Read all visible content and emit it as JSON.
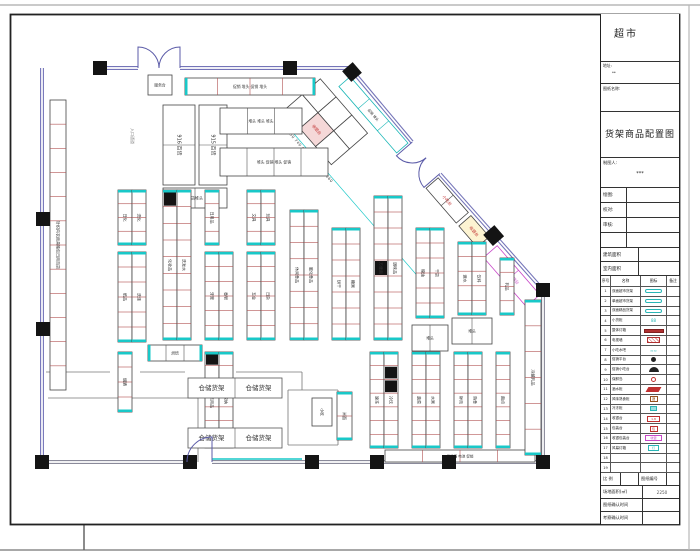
{
  "title_block": {
    "project": "超市",
    "address_label": "地址:",
    "address_value": "**",
    "drawing_name_label": "图纸名称:",
    "drawing_title": "货架商品配置图",
    "drafter_label": "制图人:",
    "drafter_value": "***",
    "sign_rows": [
      {
        "label": "绘图:"
      },
      {
        "label": "校对:"
      },
      {
        "label": "审核:"
      },
      {
        "label": ""
      }
    ],
    "area_rows": [
      {
        "label": "建筑面积"
      },
      {
        "label": "室内面积"
      }
    ],
    "legend": {
      "headers": [
        "序号",
        "名称",
        "图标",
        "备注"
      ],
      "rows": [
        {
          "no": "1",
          "name": "双面超市货架",
          "sym": "pillc",
          "symText": ""
        },
        {
          "no": "2",
          "name": "单面超市货架",
          "sym": "pillc",
          "symText": ""
        },
        {
          "no": "3",
          "name": "双面精品货架",
          "sym": "pillc",
          "symText": ""
        },
        {
          "no": "4",
          "name": "小货柜",
          "sym": "tealt",
          "symText": "88"
        },
        {
          "no": "5",
          "name": "整体灯箱",
          "sym": "barr",
          "symText": ""
        },
        {
          "no": "6",
          "name": "电视墙",
          "sym": "hatchr",
          "symText": ""
        },
        {
          "no": "7",
          "name": "小吃水吧",
          "sym": "tealt",
          "symText": "≈≈"
        },
        {
          "no": "8",
          "name": "促销平台",
          "sym": "circb",
          "symText": ""
        },
        {
          "no": "9",
          "name": "促销小吃台",
          "sym": "domeb",
          "symText": ""
        },
        {
          "no": "10",
          "name": "保鲜岛",
          "sym": "ringr",
          "symText": ""
        },
        {
          "no": "11",
          "name": "酒水柜",
          "sym": "parar",
          "symText": ""
        },
        {
          "no": "12",
          "name": "风味熟食柜",
          "sym": "boxbr",
          "symText": "酒"
        },
        {
          "no": "13",
          "name": "冷冻柜",
          "sym": "boxcf",
          "symText": ""
        },
        {
          "no": "14",
          "name": "收银台",
          "sym": "boxr",
          "symText": "1.8"
        },
        {
          "no": "15",
          "name": "包装台",
          "sym": "boxr2",
          "symText": "包"
        },
        {
          "no": "16",
          "name": "收银包装台",
          "sym": "boxm",
          "symText": "收银"
        },
        {
          "no": "17",
          "name": "风幕灯箱",
          "sym": "boxc",
          "symText": "灯"
        },
        {
          "no": "18",
          "name": "",
          "sym": "none",
          "symText": ""
        },
        {
          "no": "19",
          "name": "",
          "sym": "none",
          "symText": ""
        }
      ]
    },
    "footer": {
      "scale_label": "比 例",
      "scale_value": "",
      "no_label": "图纸编号",
      "no_value": "",
      "site_label": "场地面积(㎡)",
      "site_value": "2250",
      "confirm_drawing_label": "图纸确认时间",
      "confirm_drawing_value": "",
      "confirm_survey_label": "考察确认时间",
      "confirm_survey_value": ""
    }
  },
  "plan": {
    "walls": [
      {
        "x1": 100,
        "y1": 68,
        "x2": 138,
        "y2": 68
      },
      {
        "x1": 180,
        "y1": 68,
        "x2": 350,
        "y2": 68
      },
      {
        "x1": 350,
        "y1": 68,
        "x2": 412,
        "y2": 142
      },
      {
        "x1": 440,
        "y1": 174,
        "x2": 543,
        "y2": 290
      },
      {
        "x1": 543,
        "y1": 290,
        "x2": 543,
        "y2": 462,
        "c": "#8a8a9a"
      },
      {
        "x1": 543,
        "y1": 462,
        "x2": 212,
        "y2": 462,
        "c": "#8a8a9a"
      },
      {
        "x1": 186,
        "y1": 462,
        "x2": 42,
        "y2": 462,
        "c": "#8a8a9a"
      },
      {
        "x1": 42,
        "y1": 68,
        "x2": 42,
        "y2": 462
      }
    ],
    "lines": [
      {
        "x1": 48,
        "y1": 398,
        "x2": 198,
        "y2": 398
      },
      {
        "x1": 198,
        "y1": 398,
        "x2": 198,
        "y2": 462
      },
      {
        "x1": 46,
        "y1": 372,
        "x2": 110,
        "y2": 372
      },
      {
        "x1": 140,
        "y1": 372,
        "x2": 185,
        "y2": 372
      },
      {
        "x1": 236,
        "y1": 372,
        "x2": 302,
        "y2": 372
      },
      {
        "x1": 302,
        "y1": 372,
        "x2": 302,
        "y2": 390
      },
      {
        "x1": 288,
        "y1": 390,
        "x2": 338,
        "y2": 390
      },
      {
        "x1": 288,
        "y1": 390,
        "x2": 288,
        "y2": 445
      },
      {
        "x1": 338,
        "y1": 390,
        "x2": 338,
        "y2": 445
      },
      {
        "x1": 288,
        "y1": 445,
        "x2": 338,
        "y2": 445
      },
      {
        "x1": 212,
        "y1": 459,
        "x2": 302,
        "y2": 459,
        "c": "#19c8c8",
        "w": 1.4
      }
    ],
    "columns": [
      [
        93,
        61
      ],
      [
        283,
        61
      ],
      [
        36,
        212
      ],
      [
        36,
        322
      ],
      [
        35,
        455
      ],
      [
        183,
        455
      ],
      [
        305,
        455
      ],
      [
        370,
        455
      ],
      [
        442,
        455
      ],
      [
        536,
        455
      ],
      [
        536,
        283
      ]
    ],
    "diamond_columns": [
      [
        352,
        72
      ]
    ],
    "doors": [
      {
        "d": "M138 68 L138 47 A21 21 0 0 1 159 68"
      },
      {
        "d": "M180 68 L180 47 A21 21 0 0 0 159 68"
      },
      {
        "d": "M446 68 L446 89 A21 21 0 0 0 467 68",
        "grp": 1
      },
      {
        "d": "M488 68 L488 89 A21 21 0 0 1 467 68",
        "grp": 1
      },
      {
        "d": "M212 462 L212 437 A25 25 0 0 0 187 462"
      }
    ],
    "fixtures": [
      {
        "x": 148,
        "y": 75,
        "w": 24,
        "h": 20,
        "c": 1,
        "label": "服务台",
        "fs": 3.8
      },
      {
        "x": 185,
        "y": 78,
        "w": 130,
        "h": 17,
        "c": 4,
        "cp": 1,
        "dc": "#b05050",
        "label": "促销 堆头 促销 堆头",
        "fs": 3.8
      },
      {
        "x": 163,
        "y": 105,
        "w": 32,
        "h": 80,
        "c": 2,
        "label": "916 百货",
        "fs": 5
      },
      {
        "x": 199,
        "y": 105,
        "w": 28,
        "h": 80,
        "c": 2,
        "label": "915 百货",
        "fs": 5
      },
      {
        "x": 163,
        "y": 188,
        "w": 64,
        "h": 20,
        "c": 2,
        "label": "百货堆头",
        "fs": 4
      },
      {
        "x": 220,
        "y": 108,
        "w": 82,
        "h": 26,
        "c": 3,
        "label": "堆头 堆头 堆头",
        "fs": 3.8
      },
      {
        "x": 220,
        "y": 148,
        "w": 108,
        "h": 28,
        "c": 4,
        "label": "堆头 促销 堆头 促销",
        "fs": 3.8
      },
      {
        "x": 50,
        "y": 100,
        "w": 16,
        "h": 290,
        "c": 12,
        "dc": "#b05050",
        "label": "针织内衣雨具箱包日用百货",
        "fs": 4
      },
      {
        "x": 118,
        "y": 190,
        "w": 14,
        "h": 55,
        "c": 4,
        "cp": 1,
        "dc": "#b05050",
        "label": "日化",
        "fs": 4
      },
      {
        "x": 132,
        "y": 190,
        "w": 14,
        "h": 55,
        "c": 4,
        "cp": 1,
        "dc": "#b05050",
        "label": "洗化",
        "fs": 4
      },
      {
        "x": 118,
        "y": 252,
        "w": 14,
        "h": 90,
        "c": 6,
        "cp": 1,
        "dc": "#b05050",
        "label": "纸品",
        "fs": 4
      },
      {
        "x": 132,
        "y": 252,
        "w": 14,
        "h": 90,
        "c": 6,
        "cp": 1,
        "dc": "#b05050",
        "label": "洗涤",
        "fs": 4
      },
      {
        "x": 163,
        "y": 190,
        "w": 14,
        "h": 150,
        "c": 9,
        "cp": 1,
        "bk": [
          0
        ],
        "dc": "#b05050",
        "label": "化妆品",
        "fs": 4
      },
      {
        "x": 177,
        "y": 190,
        "w": 14,
        "h": 150,
        "c": 9,
        "cp": 1,
        "dc": "#b05050",
        "label": "洗发水",
        "fs": 4
      },
      {
        "x": 205,
        "y": 190,
        "w": 14,
        "h": 55,
        "c": 4,
        "cp": 1,
        "dc": "#b05050",
        "label": "日用品",
        "fs": 4
      },
      {
        "x": 205,
        "y": 252,
        "w": 14,
        "h": 88,
        "c": 6,
        "cp": 1,
        "dc": "#b05050",
        "label": "牙膏",
        "fs": 4
      },
      {
        "x": 219,
        "y": 252,
        "w": 14,
        "h": 88,
        "c": 6,
        "cp": 1,
        "dc": "#b05050",
        "label": "香皂",
        "fs": 4
      },
      {
        "x": 247,
        "y": 190,
        "w": 14,
        "h": 55,
        "c": 4,
        "cp": 1,
        "dc": "#b05050",
        "label": "文具",
        "fs": 4
      },
      {
        "x": 261,
        "y": 190,
        "w": 14,
        "h": 55,
        "c": 4,
        "cp": 1,
        "dc": "#b05050",
        "label": "玩具",
        "fs": 4
      },
      {
        "x": 247,
        "y": 252,
        "w": 14,
        "h": 88,
        "c": 6,
        "cp": 1,
        "dc": "#b05050",
        "label": "五金",
        "fs": 4
      },
      {
        "x": 261,
        "y": 252,
        "w": 14,
        "h": 88,
        "c": 6,
        "cp": 1,
        "dc": "#b05050",
        "label": "日杂",
        "fs": 4
      },
      {
        "x": 290,
        "y": 210,
        "w": 14,
        "h": 130,
        "c": 8,
        "cp": 1,
        "dc": "#b05050",
        "label": "休闲食品",
        "fs": 4
      },
      {
        "x": 304,
        "y": 210,
        "w": 14,
        "h": 130,
        "c": 8,
        "cp": 1,
        "dc": "#b05050",
        "label": "膨化食品",
        "fs": 4
      },
      {
        "x": 332,
        "y": 228,
        "w": 14,
        "h": 112,
        "c": 7,
        "cp": 1,
        "dc": "#b05050",
        "label": "饼干",
        "fs": 4
      },
      {
        "x": 346,
        "y": 228,
        "w": 14,
        "h": 112,
        "c": 7,
        "cp": 1,
        "dc": "#b05050",
        "label": "糖果",
        "fs": 4
      },
      {
        "x": 374,
        "y": 196,
        "w": 14,
        "h": 144,
        "c": 9,
        "cp": 1,
        "bk": [
          4
        ],
        "dc": "#b05050",
        "label": "方便面",
        "fs": 4
      },
      {
        "x": 388,
        "y": 196,
        "w": 14,
        "h": 144,
        "c": 9,
        "cp": 1,
        "dc": "#b05050",
        "label": "调味品",
        "fs": 4
      },
      {
        "x": 416,
        "y": 228,
        "w": 14,
        "h": 90,
        "c": 6,
        "cp": 1,
        "dc": "#b05050",
        "label": "粮油",
        "fs": 4
      },
      {
        "x": 430,
        "y": 228,
        "w": 14,
        "h": 90,
        "c": 6,
        "cp": 1,
        "dc": "#b05050",
        "label": "干货",
        "fs": 4
      },
      {
        "x": 458,
        "y": 242,
        "w": 14,
        "h": 73,
        "c": 5,
        "cp": 1,
        "dc": "#b05050",
        "label": "酒水",
        "fs": 4
      },
      {
        "x": 472,
        "y": 242,
        "w": 14,
        "h": 73,
        "c": 5,
        "cp": 1,
        "dc": "#b05050",
        "label": "饮料",
        "fs": 4
      },
      {
        "x": 500,
        "y": 258,
        "w": 14,
        "h": 57,
        "c": 4,
        "cp": 1,
        "dc": "#b05050",
        "label": "乳品",
        "fs": 4
      },
      {
        "x": 412,
        "y": 325,
        "w": 36,
        "h": 26,
        "c": 2,
        "label": "堆头",
        "fs": 3.8
      },
      {
        "x": 452,
        "y": 318,
        "w": 40,
        "h": 26,
        "c": 2,
        "label": "堆头",
        "fs": 3.8
      },
      {
        "x": 118,
        "y": 352,
        "w": 14,
        "h": 60,
        "c": 4,
        "cp": 1,
        "dc": "#b05050",
        "label": "烟酒",
        "fs": 4
      },
      {
        "x": 205,
        "y": 352,
        "w": 14,
        "h": 96,
        "c": 7,
        "cp": 1,
        "bk": [
          0
        ],
        "dc": "#b05050",
        "label": "清洁用品",
        "fs": 4
      },
      {
        "x": 219,
        "y": 352,
        "w": 14,
        "h": 96,
        "c": 7,
        "cp": 1,
        "dc": "#b05050",
        "label": "收纳",
        "fs": 4
      },
      {
        "x": 337,
        "y": 392,
        "w": 15,
        "h": 48,
        "c": 2,
        "cp": 1,
        "dc": "#b05050",
        "label": "米面",
        "fs": 4
      },
      {
        "x": 312,
        "y": 398,
        "w": 20,
        "h": 28,
        "c": 1,
        "label": "小吃",
        "fs": 3.8
      },
      {
        "x": 370,
        "y": 352,
        "w": 14,
        "h": 96,
        "c": 7,
        "cp": 1,
        "dc": "#b05050",
        "label": "速冻",
        "fs": 4
      },
      {
        "x": 384,
        "y": 352,
        "w": 14,
        "h": 96,
        "c": 7,
        "cp": 1,
        "bk": [
          1,
          2
        ],
        "dc": "#b05050",
        "label": "冷饮",
        "fs": 4
      },
      {
        "x": 412,
        "y": 352,
        "w": 14,
        "h": 96,
        "c": 7,
        "cp": 1,
        "dc": "#b05050",
        "label": "蔬菜",
        "fs": 4
      },
      {
        "x": 426,
        "y": 352,
        "w": 14,
        "h": 96,
        "c": 7,
        "cp": 1,
        "dc": "#b05050",
        "label": "水果",
        "fs": 4
      },
      {
        "x": 454,
        "y": 352,
        "w": 14,
        "h": 96,
        "c": 7,
        "cp": 1,
        "dc": "#b05050",
        "label": "鲜肉",
        "fs": 4
      },
      {
        "x": 468,
        "y": 352,
        "w": 14,
        "h": 96,
        "c": 7,
        "cp": 1,
        "dc": "#b05050",
        "label": "熟食",
        "fs": 4
      },
      {
        "x": 496,
        "y": 352,
        "w": 14,
        "h": 96,
        "c": 7,
        "cp": 1,
        "dc": "#b05050",
        "label": "面点",
        "fs": 4
      },
      {
        "x": 385,
        "y": 450,
        "w": 150,
        "h": 12,
        "c": 4,
        "dc": "#b05050",
        "label": "口香糖 电池 促销",
        "fs": 3.5
      },
      {
        "x": 148,
        "y": 345,
        "w": 54,
        "h": 16,
        "c": 3,
        "cp": 1,
        "label": "烘焙",
        "fs": 3.8
      },
      {
        "x": 188,
        "y": 378,
        "w": 94,
        "h": 20,
        "c": 2,
        "sc": "#555",
        "cl": [
          "仓储货架",
          "仓储货架"
        ],
        "fs": 6.5
      },
      {
        "x": 188,
        "y": 428,
        "w": 94,
        "h": 20,
        "c": 2,
        "sc": "#555",
        "cl": [
          "仓储货架",
          "仓储货架"
        ],
        "fs": 6.5
      },
      {
        "x": 525,
        "y": 300,
        "w": 16,
        "h": 155,
        "c": 6,
        "cp": 1,
        "dc": "#b05050",
        "label": "冷藏乳品",
        "fs": 4
      }
    ],
    "diag_fixtures": [
      {
        "u": 8,
        "v": 4,
        "len": 88,
        "wid": 15,
        "c": 3,
        "sc": "#19b6b6",
        "dc": "#19b6b6",
        "label": "促销 堆头",
        "fs": 3.5
      },
      {
        "u": 142,
        "v": 4,
        "len": 46,
        "wid": 16,
        "c": 2,
        "label": "小吃台",
        "lc": "#c03030",
        "fs": 4
      },
      {
        "u": 192,
        "v": 4,
        "len": 28,
        "wid": 16,
        "c": 1,
        "fill": "#fdf4d2",
        "label": "收银台",
        "lc": "#c03030",
        "fs": 4
      },
      {
        "u": 215,
        "v": -7,
        "len": 14,
        "wid": 14,
        "c": 1,
        "fill": "#141414",
        "sc": "#141414"
      },
      {
        "u": 232,
        "v": 4,
        "len": 65,
        "wid": 18,
        "c": 2,
        "sc": "#c849c8",
        "dc": "#c849c8",
        "label": "收银包装台",
        "lc": "#c849c8",
        "fs": 4
      },
      {
        "u": -10,
        "v": 28,
        "len": 24,
        "wid": 24,
        "c": 1
      },
      {
        "u": 14,
        "v": 28,
        "len": 24,
        "wid": 24,
        "c": 1
      },
      {
        "u": 38,
        "v": 28,
        "len": 24,
        "wid": 24,
        "c": 1
      },
      {
        "u": -10,
        "v": 52,
        "len": 24,
        "wid": 24,
        "c": 1
      },
      {
        "u": 14,
        "v": 52,
        "len": 24,
        "wid": 24,
        "c": 1,
        "fill": "#f5d8d8",
        "label": "收银台",
        "lc": "#c03030",
        "fs": 4
      },
      {
        "u": 38,
        "v": 52,
        "len": 24,
        "wid": 24,
        "c": 1
      }
    ],
    "diag_lines": [
      {
        "u1": -14,
        "v1": 84,
        "u2": 230,
        "v2": 84,
        "c": "#19c8c8",
        "w": 0.7
      }
    ],
    "texts": [
      {
        "x": 131,
        "y": 128,
        "t": "入口通道",
        "rot": 90,
        "s": 4,
        "c": "#888"
      },
      {
        "u": -12,
        "v": 88,
        "t": "650 640 650 740 650 3450 730 1060",
        "s": 3.8,
        "c": "#444",
        "ls": 0.5
      }
    ]
  },
  "colors": {
    "wall": "#7474b8",
    "cap_cyan": "#19c8c8",
    "divider_red": "#b05050",
    "counter_magenta": "#c849c8",
    "highlight_red": "#c03030",
    "column_black": "#141414"
  }
}
